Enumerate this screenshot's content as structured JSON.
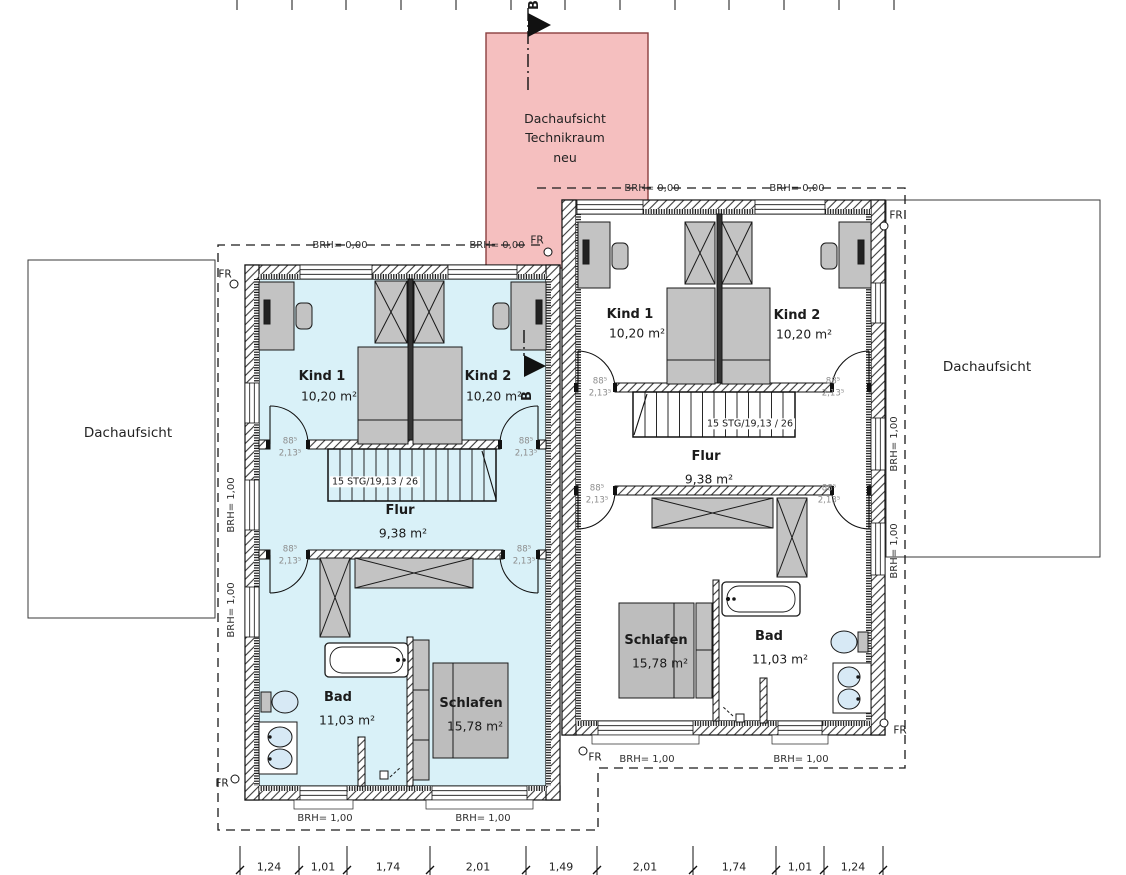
{
  "colors": {
    "apartment_fill": "#d9f1f8",
    "tech_room_fill": "#f5bfbf",
    "tech_room_border": "#8a3f3f",
    "furniture": "#c3c3c3",
    "fixture_blue": "#d7e9f5"
  },
  "labels": {
    "roof_left": "Dachaufsicht",
    "roof_right": "Dachaufsicht",
    "tech_room": "Dachaufsicht\nTechnikraum\nneu",
    "section_letter": "B",
    "fr": "FR",
    "brh_zero": "BRH= 0,00",
    "brh_one": "BRH= 1,00",
    "stairs": "15 STG/19,13 / 26"
  },
  "rooms": {
    "kind1": {
      "name": "Kind 1",
      "area": "10,20 m²"
    },
    "kind2": {
      "name": "Kind 2",
      "area": "10,20 m²"
    },
    "flur": {
      "name": "Flur",
      "area": "9,38 m²"
    },
    "bad": {
      "name": "Bad",
      "area": "11,03 m²"
    },
    "schlafen": {
      "name": "Schlafen",
      "area": "15,78 m²"
    }
  },
  "door_tag": {
    "width": "88⁵",
    "height": "2,13⁵"
  },
  "dimensions": [
    "1,24",
    "1,01",
    "1,74",
    "2,01",
    "1,49",
    "2,01",
    "1,74",
    "1,01",
    "1,24"
  ]
}
